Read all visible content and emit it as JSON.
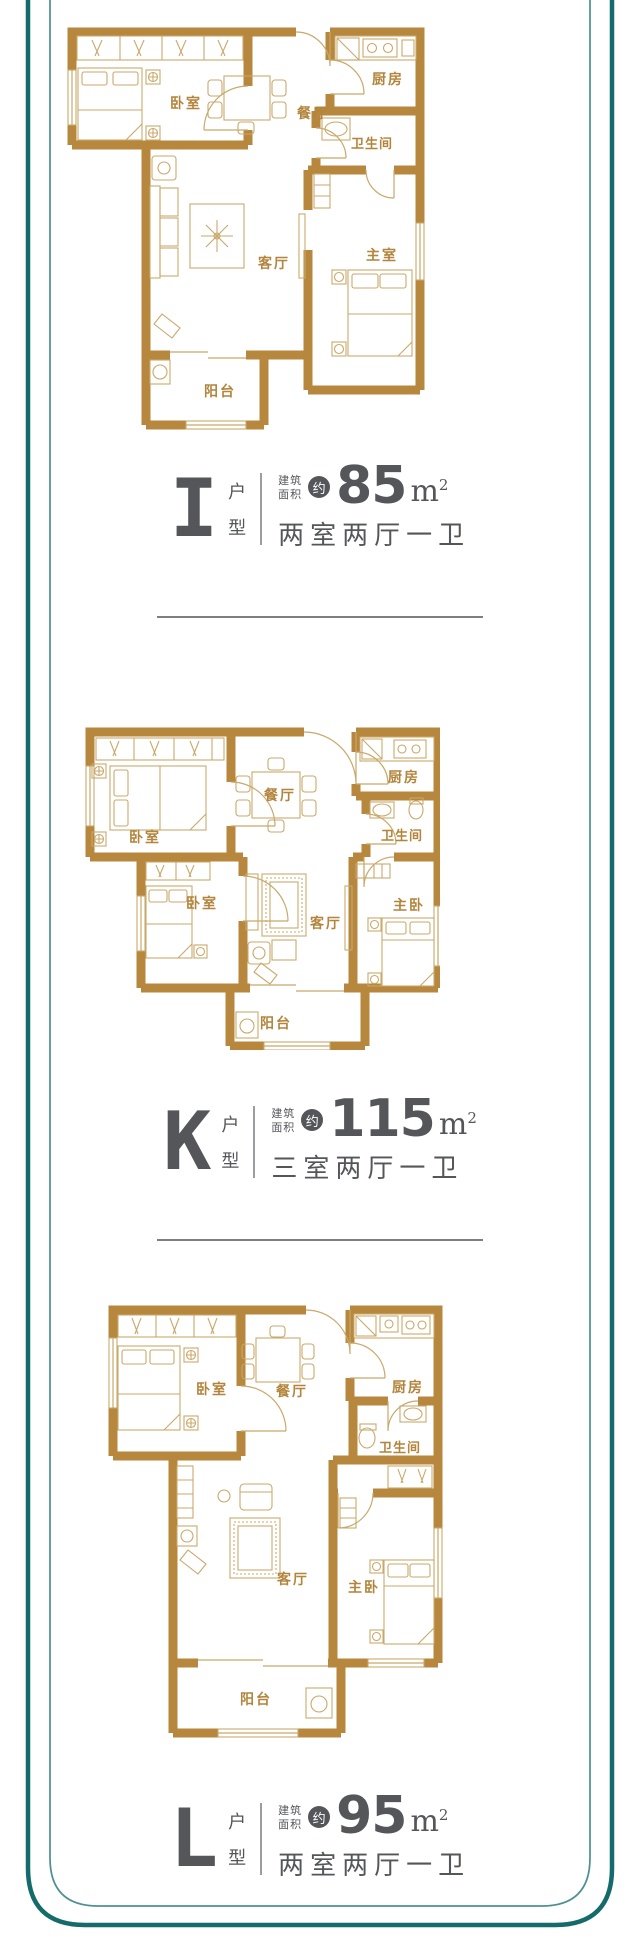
{
  "palette": {
    "wall_gold": "#b6873c",
    "furniture_gold": "#c9a86b",
    "room_label_gold": "#b3843c",
    "label_gray": "#55565a",
    "frame_teal_dark": "#156a6c",
    "frame_teal_light": "#4d9092",
    "divider_gray": "#7d7f81"
  },
  "label_parts": {
    "suffix_top": "户",
    "suffix_bottom": "型",
    "area_line1": "建筑",
    "area_line2": "面积",
    "approx": "约",
    "area_unit": "m",
    "area_unit_sup": "2"
  },
  "units": [
    {
      "type_letter": "I",
      "area_value": "85",
      "layout_text": "两室两厅一卫",
      "rooms": [
        {
          "name": "卧室"
        },
        {
          "name": "餐厅"
        },
        {
          "name": "厨房"
        },
        {
          "name": "卫生间"
        },
        {
          "name": "客厅"
        },
        {
          "name": "主室"
        },
        {
          "name": "阳台"
        }
      ]
    },
    {
      "type_letter": "K",
      "area_value": "115",
      "layout_text": "三室两厅一卫",
      "rooms": [
        {
          "name": "卧室"
        },
        {
          "name": "餐厅"
        },
        {
          "name": "厨房"
        },
        {
          "name": "卫生间"
        },
        {
          "name": "卧室"
        },
        {
          "name": "客厅"
        },
        {
          "name": "主卧"
        },
        {
          "name": "阳台"
        }
      ]
    },
    {
      "type_letter": "L",
      "area_value": "95",
      "layout_text": "两室两厅一卫",
      "rooms": [
        {
          "name": "卧室"
        },
        {
          "name": "餐厅"
        },
        {
          "name": "厨房"
        },
        {
          "name": "卫生间"
        },
        {
          "name": "客厅"
        },
        {
          "name": "主卧"
        },
        {
          "name": "阳台"
        }
      ]
    }
  ]
}
